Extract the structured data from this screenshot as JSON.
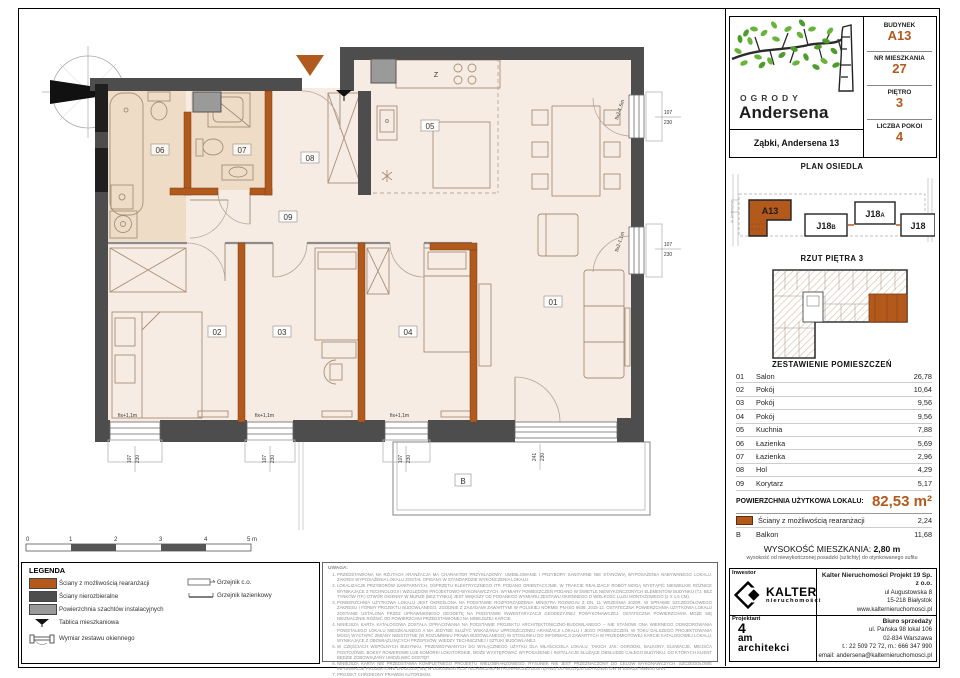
{
  "colors": {
    "accent": "#b4591c",
    "wall_dark": "#4d4d4d",
    "wall_black": "#1f1f1f",
    "shaft_gray": "#9a9a9a",
    "floor": "#f7ece3",
    "floor_bath": "#efdcc6",
    "leaf_green": "#68b43a"
  },
  "header": {
    "brand_line1": "OGRODY",
    "brand_line2": "Andersena",
    "address": "Ząbki, Andersena 13",
    "info": [
      {
        "label": "BUDYNEK",
        "value": "A13"
      },
      {
        "label": "NR MIESZKANIA",
        "value": "27"
      },
      {
        "label": "PIĘTRO",
        "value": "3"
      },
      {
        "label": "LICZBA POKOI",
        "value": "4"
      }
    ]
  },
  "site_plan": {
    "title": "PLAN OSIEDLA",
    "street_left": "ul. Andersena",
    "buildings": {
      "a13": "A13",
      "j18b": "J18",
      "j18b_sub": "B",
      "j18a": "J18",
      "j18a_sub": "A",
      "j18": "J18"
    }
  },
  "floor_plan_thumb": {
    "title": "RZUT PIĘTRA 3"
  },
  "rooms": {
    "title": "ZESTAWIENIE POMIESZCZEŃ",
    "rows": [
      {
        "no": "01",
        "name": "Salon",
        "area": "26,78"
      },
      {
        "no": "02",
        "name": "Pokój",
        "area": "10,64"
      },
      {
        "no": "03",
        "name": "Pokój",
        "area": "9,56"
      },
      {
        "no": "04",
        "name": "Pokój",
        "area": "9,56"
      },
      {
        "no": "05",
        "name": "Kuchnia",
        "area": "7,88"
      },
      {
        "no": "06",
        "name": "Łazienka",
        "area": "5,69"
      },
      {
        "no": "07",
        "name": "Łazienka",
        "area": "2,96"
      },
      {
        "no": "08",
        "name": "Hol",
        "area": "4,29"
      },
      {
        "no": "09",
        "name": "Korytarz",
        "area": "5,17"
      }
    ],
    "total_label": "POWIERZCHNIA UŻYTKOWA LOKALU:",
    "total_value": "82,53 m²",
    "walls_row": {
      "name": "Ściany z możliwością rearanżacji",
      "area": "2,24"
    },
    "balcony_row": {
      "no": "B",
      "name": "Balkon",
      "area": "11,68"
    }
  },
  "height": {
    "label": "WYSOKOŚĆ MIESZKANIA:",
    "value": "2,80 m",
    "note": "wysokość od niewykończonej posadzki (szlichty) do otynkowanego sufitu"
  },
  "contacts": {
    "investor_label": "Inwestor",
    "kalter_name": "KALTER",
    "kalter_sub": "nieruchomości",
    "company": "Kalter Nieruchomości Projekt 19 Sp. z o.o.",
    "company_line1": "ul Augustowska 8",
    "company_line2": "15-218 Białystok",
    "company_line3": "www.kalternieruchomosci.pl",
    "designer_label": "Projektant",
    "designer_l1": "4",
    "designer_l2": "am",
    "designer_l3": "architekci",
    "office_title": "Biuro sprzedaży",
    "office_line1": "ul. Pańska 98 lokal 106",
    "office_line2": "02-834 Warszawa",
    "office_line3": "t.: 22 509 72 72, m.: 666 347 990",
    "office_line4": "email: andersena@kalternieruchomosci.pl"
  },
  "legend": {
    "title": "LEGENDA",
    "items": [
      {
        "icon": "swatch-rearrangeable",
        "label": "Ściany z możliwością rearanżacji"
      },
      {
        "icon": "swatch-structural",
        "label": "Ściany nierozbieralne"
      },
      {
        "icon": "swatch-shaft",
        "label": "Powierzchnia szachtów instalacyjnych"
      },
      {
        "icon": "apartment-board",
        "label": "Tablica mieszkaniowa"
      },
      {
        "icon": "window-dimension",
        "label": "Wymiar zestawu okiennego"
      }
    ],
    "items_right": [
      {
        "icon": "radiator-co",
        "label": "Grzejnik c.o."
      },
      {
        "icon": "radiator-bathroom",
        "label": "Grzejnik łazienkowy"
      }
    ]
  },
  "notes": {
    "title": "UWAGA:",
    "items": [
      "PRZEDSTAWIONA NA RZUTACH ARANŻACJA MA CHARAKTER PRZYKŁADOWY. UMEBLOWANIE I PRZYBORY SANITARNE NIE STANOWIĄ WYPOSAŻENIA NABYWANEGO LOKALU. ZAKRES WYPOSAŻENIA LOKALU ZOSTAŁ OPISANY W STANDARDZIE WYKOŃCZENIA LOKALU.",
      "LOKALIZACJE PRZYBORÓW SANITARNYCH, OSPRZĘTU ELEKTRYCZNEGO ITP. PODANO ORIENTACYJNIE. W TRAKCIE REALIZACJI ROBÓT MOGĄ WYSTĄPIĆ NIEWIELKIE RÓŻNICE WYNIKAJĄCE Z TECHNOLOGII I WZGLĘDÓW PROJEKTOWO-WYKONAWCZYCH. WYMIARY POMIESZCZEŃ PODANO W ŚWIETLE NIEWYKOŃCZONYCH ELEMENTÓW BUDYNKU (TJ. BEZ TYNKÓW ITP.) OTWÓR OKIENNY W MURZE (BEZ TYNKU) JEST WIĘKSZY OD PODANEGO WYMIARU ZESTAWU OKIENNEGO O WIELKOŚĆ LUZU MONTAŻOWEGO (2 X 1,5 CM).",
      "POWIERZCHNIA UŻYTKOWA LOKALU JEST OKREŚLONA NA PODSTAWIE ROZPORZĄDZENIA MINISTRA ROZWOJU Z DN. 11 WRZEŚNIA 2020R. W SPRAWIE SZCZEGÓŁOWEGO ZAKRESU I FORMY PROJEKTU BUDOWLANEGO, ZGODNIE Z ZASADAMI ZAWARTYMI W POLSKIEJ NORMIE PN-ISO 9836: 2015-12. OSTATECZNA POWIERZCHNIA UŻYTKOWA LOKALU ZOSTANIE USTALONA PRZEZ UPRAWNIONEGO GEODETĘ NA PODSTAWIE INWENTARYZACJI GEODEZYJNEJ POWYKONAWCZEJ. OSTATECZNA POWIERZCHNIA MOŻE SIĘ NIEZNACZNIE RÓŻNIĆ OD POWIERZCHNI PRZEDSTAWIONEJ NA NINIEJSZEJ KARCIE.",
      "NINIEJSZA KARTA KATALOGOWA ZOSTAŁA OPRACOWANA NA PODSTAWIE PROJEKTU ARCHITEKTONICZNO-BUDOWLANEGO – NIE STANOWI ONA WIERNEGO ODWZOROWANIA POWSTAŁEGO LOKALU MIESZKALNEGO A MA JEDYNIE SŁUŻYĆ WSKAZANIU UPROSZCZONEJ ARANŻACJI LOKALU I JEGO POMIESZCZEŃ. W TOKU DALSZEGO PROJEKTOWANIA MOGĄ WYSTĄPIĆ ZMIANY NIEISTOTNE (W ROZUMIENIU PRAWA BUDOWLANEGO) W STOSUNKU DO INFORMACJI ZAWARTYCH W PRZEDMIOTOWEJ KARCIE KATALOGOWEJ LOKALU, WYNIKAJĄCE Z OBOWIĄZUJĄCYCH PRZEPISÓW, WIEDZY TECHNICZNEJ I SZTUKI BUDOWLANEJ.",
      "W CZĘŚCIACH WSPÓLNYCH BUDYNKU, PRZEWIDYWANYCH DO WYŁĄCZNEGO UŻYTKU DLA WŁAŚCICIELA LOKALU, TAKICH JAK: OGRÓDKI, BALKONY, ELEWACJE, MIEJSCA POSTOJOWE, BOKSY ROWEROWE LUB KOMÓRKI LOKATORSKIE, MOŻE WYSTĘPOWAĆ WYPOSAŻENIE I INSTALACJE SŁUŻĄCE OBSŁUDZE CAŁEGO BUDYNKU, DO KTÓRYCH KLIENT BĘDZIE ZOBOWIĄZANY UMOŻLIWIĆ DOSTĘP.",
      "NINIEJSZA KARTA NIE PRZEDSTAWIA KOMPLETNEGO PROJEKTU WIELOBRANŻOWEGO. RYSUNEK NIE JEST PRZEZNACZONY DO CELÓW WYKONAWCZYCH. SZCZEGÓŁOWE INFORMACJE PROJEKTOWE ZNAJDUJĄ SIĘ W DOKUMENTACJI TECHNICZNO-WYKONAWCZEJ DOSTĘPNEJ DO WGLĄDU DLA KLIENTÓW W BIURZE INWESTORA.",
      "PROJEKT CHRONIONY PRAWEM AUTORSKIM."
    ]
  },
  "plan": {
    "north": "N",
    "labels": {
      "r01": "01",
      "r02": "02",
      "r03": "03",
      "r04": "04",
      "r05": "05",
      "r06": "06",
      "r07": "07",
      "r08": "08",
      "r09": "09",
      "balcony": "B",
      "kitchen_sink": "Z"
    },
    "windows": {
      "fix_bottom": "fix+1,1m",
      "fix_right_top": "fix2-1,5m",
      "fix_right": "fix2-1,1m",
      "dim_w_107": "107",
      "dim_h_230": "230",
      "dim_w_241": "241"
    }
  },
  "scale_bar": {
    "ticks": [
      "0",
      "1",
      "2",
      "3",
      "4",
      "5 m"
    ]
  }
}
